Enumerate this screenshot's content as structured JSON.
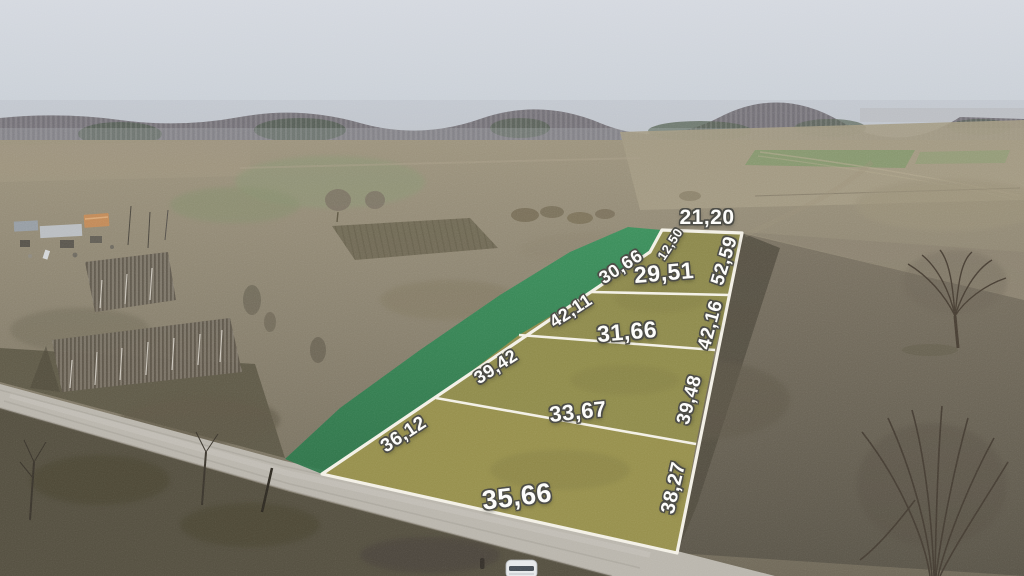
{
  "overlay": {
    "colors": {
      "plot_fill": "#918d4d",
      "buffer_strip_fill": "#2e8050",
      "boundary_line": "#f3f0e6",
      "label_text": "#fdfdfb",
      "label_outline": "#4d4d47"
    },
    "far_edge": {
      "top_width": "21,20",
      "jog_width": "12,50"
    },
    "plots": [
      {
        "name": "plot-far",
        "front_width": "29,51",
        "back_width": "30,66",
        "right_side": "52,59"
      },
      {
        "name": "plot-mid-far",
        "front_width": "31,66",
        "back_width": "42,11",
        "right_side": "42,16"
      },
      {
        "name": "plot-mid-near",
        "front_width": "33,67",
        "back_width": "39,42",
        "right_side": "39,48"
      },
      {
        "name": "plot-near",
        "front_width": "35,66",
        "back_width": "36,12",
        "right_side": "38,27"
      }
    ]
  }
}
